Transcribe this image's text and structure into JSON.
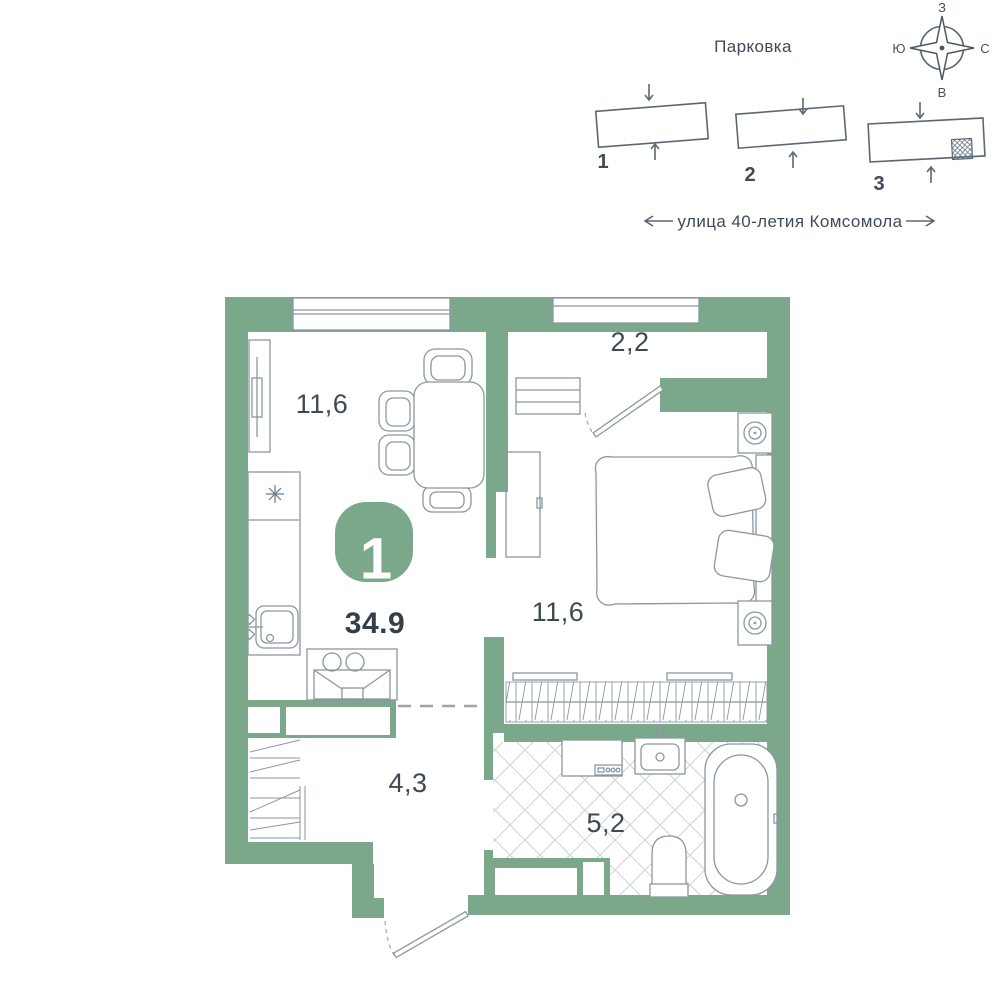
{
  "site_plan": {
    "parking_label": "Парковка",
    "street": {
      "label": "улица 40-летия Комсомола"
    },
    "compass": {
      "top": "З",
      "right": "С",
      "bottom": "В",
      "left": "Ю"
    },
    "buildings": [
      {
        "number": "1",
        "current": false
      },
      {
        "number": "2",
        "current": false
      },
      {
        "number": "3",
        "current": true
      }
    ]
  },
  "floor_plan": {
    "badge": {
      "rooms_count": "1",
      "total_area": "34.9"
    },
    "rooms": [
      {
        "id": "kitchen-living",
        "area": "11,6"
      },
      {
        "id": "balcony",
        "area": "2,2"
      },
      {
        "id": "bedroom",
        "area": "11,6"
      },
      {
        "id": "hallway",
        "area": "4,3"
      },
      {
        "id": "bathroom",
        "area": "5,2"
      }
    ]
  },
  "colors": {
    "wall_green": "#7BA88B",
    "badge_green": "#7BA88B",
    "furniture_line": "#8B97A1",
    "dark_text": "#3D4A54",
    "site_line": "#5B6874",
    "tile_line": "#CCD4D1"
  }
}
